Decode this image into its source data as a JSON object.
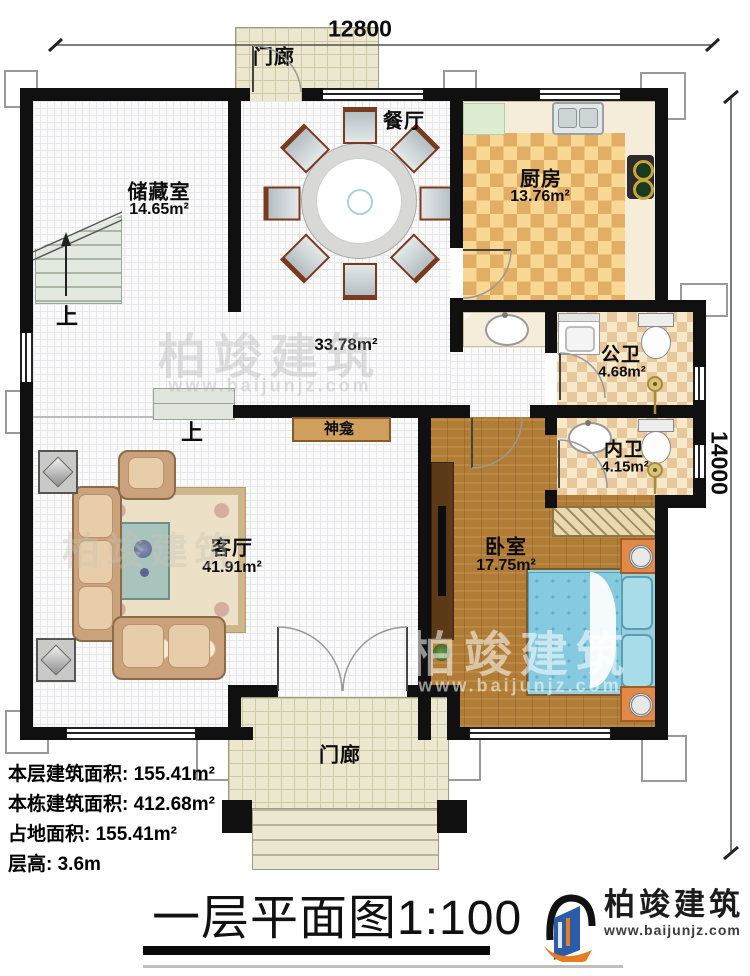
{
  "dimensions": {
    "width_label": "12800",
    "height_label": "14000"
  },
  "rooms": {
    "porch_top": {
      "name": "门廊"
    },
    "dining": {
      "name": "餐厅"
    },
    "kitchen": {
      "name": "厨房",
      "area": "13.76m²"
    },
    "storage": {
      "name": "储藏室",
      "area": "14.65m²"
    },
    "hall": {
      "area": "33.78m²"
    },
    "public_bath": {
      "name": "公卫",
      "area": "4.68m²"
    },
    "private_bath": {
      "name": "内卫",
      "area": "4.15m²"
    },
    "bedroom": {
      "name": "卧室",
      "area": "17.75m²"
    },
    "living": {
      "name": "客厅",
      "area": "41.91m²"
    },
    "shrine": {
      "name": "神龛"
    },
    "porch_bottom": {
      "name": "门廊"
    },
    "stairs_up": {
      "label": "上"
    },
    "steps_up": {
      "label": "上"
    }
  },
  "info": {
    "lines": [
      {
        "label": "本层建筑面积:",
        "value": "155.41m²"
      },
      {
        "label": "本栋建筑面积:",
        "value": "412.68m²"
      },
      {
        "label": "占地面积:",
        "value": "155.41m²"
      },
      {
        "label": "层高:",
        "value": "3.6m"
      }
    ]
  },
  "title": {
    "text": "一层平面图",
    "scale": "1:100"
  },
  "brand": {
    "name": "柏竣建筑",
    "url": "www.baijunjz.com"
  },
  "watermark": {
    "name": "柏竣建筑",
    "url": "www.baijunjz.com"
  },
  "colors": {
    "wall": "#101010",
    "wood_floor": "#b07c36",
    "kitchen_tile_dark": "#e2ae66",
    "kitchen_tile_light": "#f9d894",
    "bath_tile_dark": "#e6c89c",
    "bath_tile_light": "#f6e8c9",
    "porch_floor": "#ece7cf",
    "bed_blue": "#85cade",
    "nightstand_orange": "#e08948",
    "shrine_tan": "#cf9f5e",
    "logo_blue": "#2a5caa",
    "logo_orange": "#e87d1e"
  }
}
